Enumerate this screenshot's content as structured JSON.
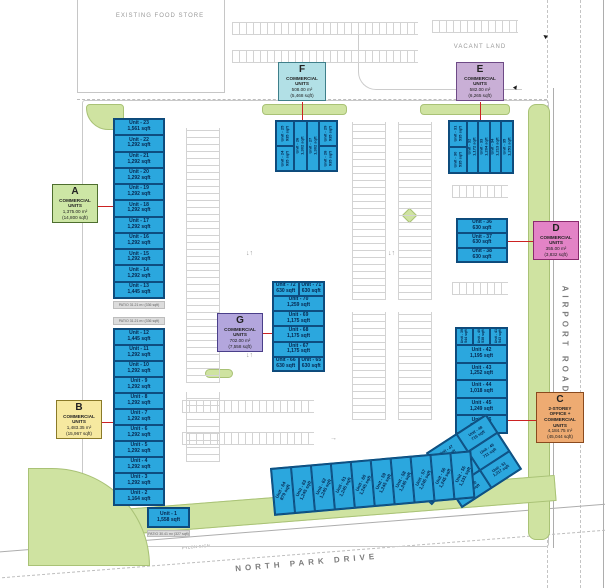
{
  "labels": {
    "existing_food_store": "EXISTING FOOD STORE",
    "vacant_land": "VACANT LAND",
    "airport_road": "AIRPORT ROAD",
    "north_park_drive": "NORTH PARK DRIVE",
    "pylon_sign": "PYLON SIGN"
  },
  "colors": {
    "unit_fill": "#2ba7de",
    "unit_border": "#0d4a7a",
    "landscape_green": "#cfe3a1",
    "leader_red": "#cc2222",
    "legend_a": "#cde6a5",
    "legend_b": "#f6e9a0",
    "legend_c": "#eeab72",
    "legend_d": "#e383c6",
    "legend_e": "#c9afd6",
    "legend_f": "#b2e0e6",
    "legend_g": "#b3a6dd"
  },
  "legend": {
    "a": {
      "letter": "A",
      "line1": "COMMERCIAL",
      "line2": "UNITS",
      "area_m2": "1,375.00 m²",
      "area_sqft": "(14,800 sqft)"
    },
    "b": {
      "letter": "B",
      "line1": "COMMERCIAL",
      "line2": "UNITS",
      "area_m2": "1,483.35 m²",
      "area_sqft": "(15,967 sqft)"
    },
    "c": {
      "letter": "C",
      "line1": "2-STOREY",
      "line2": "OFFICE +",
      "line3": "COMMERCIAL",
      "line4": "UNITS",
      "area_m2": "4,184.75 m²",
      "area_sqft": "(45,044 sqft)"
    },
    "d": {
      "letter": "D",
      "line1": "COMMERCIAL",
      "line2": "UNITS",
      "area_m2": "355.00 m²",
      "area_sqft": "(3,832 sqft)"
    },
    "e": {
      "letter": "E",
      "line1": "COMMERCIAL",
      "line2": "UNITS",
      "area_m2": "582.00 m²",
      "area_sqft": "(6,265 sqft)"
    },
    "f": {
      "letter": "F",
      "line1": "COMMERCIAL",
      "line2": "UNITS",
      "area_m2": "508.00 m²",
      "area_sqft": "(5,468 sqft)"
    },
    "g": {
      "letter": "G",
      "line1": "COMMERCIAL",
      "line2": "UNITS",
      "area_m2": "702.00 m²",
      "area_sqft": "(7,558 sqft)"
    }
  },
  "buildings": {
    "block_a": {
      "units": [
        {
          "n": "Unit - 23",
          "a": "1,561 sqft"
        },
        {
          "n": "Unit - 22",
          "a": "1,292 sqft"
        },
        {
          "n": "Unit - 21",
          "a": "1,292 sqft"
        },
        {
          "n": "Unit - 20",
          "a": "1,292 sqft"
        },
        {
          "n": "Unit - 19",
          "a": "1,292 sqft"
        },
        {
          "n": "Unit - 18",
          "a": "1,292 sqft"
        },
        {
          "n": "Unit - 17",
          "a": "1,292 sqft"
        },
        {
          "n": "Unit - 16",
          "a": "1,292 sqft"
        },
        {
          "n": "Unit - 15",
          "a": "1,292 sqft"
        },
        {
          "n": "Unit - 14",
          "a": "1,292 sqft"
        },
        {
          "n": "Unit - 13",
          "a": "1,445 sqft"
        }
      ]
    },
    "block_b": {
      "units": [
        {
          "n": "Unit - 12",
          "a": "1,445 sqft"
        },
        {
          "n": "Unit - 11",
          "a": "1,292 sqft"
        },
        {
          "n": "Unit - 10",
          "a": "1,292 sqft"
        },
        {
          "n": "Unit - 9",
          "a": "1,292 sqft"
        },
        {
          "n": "Unit - 8",
          "a": "1,292 sqft"
        },
        {
          "n": "Unit - 7",
          "a": "1,292 sqft"
        },
        {
          "n": "Unit - 6",
          "a": "1,292 sqft"
        },
        {
          "n": "Unit - 5",
          "a": "1,292 sqft"
        },
        {
          "n": "Unit - 4",
          "a": "1,292 sqft"
        },
        {
          "n": "Unit - 3",
          "a": "1,292 sqft"
        },
        {
          "n": "Unit - 2",
          "a": "1,164 sqft"
        }
      ],
      "unit1": {
        "n": "Unit - 1",
        "a": "1,558 sqft"
      }
    },
    "patio1": "PATIO 31.21 m² (336 sqft)",
    "patio2": "PATIO 31.21 m² (336 sqft)",
    "patio3": "PATIO 30.41 m² (327 sqft)",
    "f": {
      "u24": {
        "n": "Unit - 24",
        "a": "935 sqft"
      },
      "u25": {
        "n": "Unit - 25",
        "a": "935 sqft"
      },
      "u26": {
        "n": "Unit - 26",
        "a": "1,302 sqft"
      },
      "u27": {
        "n": "Unit - 27",
        "a": "1,302 sqft"
      },
      "u28": {
        "n": "Unit - 28",
        "a": "935 sqft"
      },
      "u29": {
        "n": "Unit - 29",
        "a": "935 sqft"
      }
    },
    "e": {
      "u30": {
        "n": "Unit - 30",
        "a": "535 sqft"
      },
      "u31": {
        "n": "Unit - 31",
        "a": "535 sqft"
      },
      "u32": {
        "n": "Unit - 32",
        "a": "1,172 sqft"
      },
      "u33": {
        "n": "Unit - 33",
        "a": "1,204 sqft"
      },
      "u34": {
        "n": "Unit - 34",
        "a": "1,213 sqft"
      },
      "u35": {
        "n": "Unit - 35",
        "a": "1,251 sqft"
      }
    },
    "d": {
      "u36": {
        "n": "Unit - 36",
        "a": "630 sqft"
      },
      "u37": {
        "n": "Unit - 37",
        "a": "630 sqft"
      },
      "u38": {
        "n": "Unit - 38",
        "a": "630 sqft"
      }
    },
    "g": {
      "u72": {
        "n": "Unit - 72",
        "a": "630 sqft"
      },
      "u71": {
        "n": "Unit - 71",
        "a": "630 sqft"
      },
      "u70": {
        "n": "Unit - 70",
        "a": "1,259 sqft"
      },
      "u69": {
        "n": "Unit - 69",
        "a": "1,175 sqft"
      },
      "u68": {
        "n": "Unit - 68",
        "a": "1,175 sqft"
      },
      "u67": {
        "n": "Unit - 67",
        "a": "1,175 sqft"
      },
      "u66": {
        "n": "Unit - 66",
        "a": "630 sqft"
      },
      "u65": {
        "n": "Unit - 65",
        "a": "630 sqft"
      }
    },
    "c": {
      "u39": {
        "n": "Unit - 39",
        "a": "544 sqft"
      },
      "u40": {
        "n": "Unit - 40",
        "a": "538 sqft"
      },
      "u41": {
        "n": "Unit - 41",
        "a": "543 sqft"
      },
      "u42": {
        "n": "Unit - 42",
        "a": "1,195 sqft"
      },
      "u43": {
        "n": "Unit - 43",
        "a": "1,252 sqft"
      },
      "u44": {
        "n": "Unit - 44",
        "a": "1,018 sqft"
      },
      "u45": {
        "n": "Unit - 45",
        "a": "1,249 sqft"
      },
      "u46": {
        "n": "Unit - 46",
        "a": "1,248 sqft"
      },
      "u47": {
        "n": "Unit - 47",
        "a": "957 sqft"
      },
      "u48": {
        "n": "Unit - 48",
        "a": "715 sqft"
      },
      "lobby": {
        "n": "Lobby",
        "a": "1,131 sqft"
      },
      "u49": {
        "n": "Unit - 49",
        "a": "711 sqft"
      },
      "u50": {
        "n": "Unit - 50",
        "a": "1,237 sqft"
      },
      "u51": {
        "n": "Unit - 51",
        "a": "1,217 sqft"
      },
      "u52": {
        "n": "Unit - 52",
        "a": "510 sqft"
      },
      "u53": {
        "n": "Unit - 53",
        "a": "510 sqft"
      },
      "u54": {
        "n": "Unit - 54",
        "a": "510 sqft"
      }
    },
    "south_strip": {
      "units": [
        {
          "n": "Unit - 64",
          "a": "879 sqft"
        },
        {
          "n": "Unit - 63",
          "a": "1,245 sqft"
        },
        {
          "n": "Unit - 62",
          "a": "1,245 sqft"
        },
        {
          "n": "Unit - 61",
          "a": "1,245 sqft"
        },
        {
          "n": "Unit - 60",
          "a": "1,245 sqft"
        },
        {
          "n": "Unit - 59",
          "a": "1,245 sqft"
        },
        {
          "n": "Unit - 58",
          "a": "1,245 sqft"
        },
        {
          "n": "Unit - 57",
          "a": "1,245 sqft"
        },
        {
          "n": "Unit - 56",
          "a": "1,245 sqft"
        },
        {
          "n": "Unit - 55",
          "a": "1,131 sqft"
        }
      ]
    }
  }
}
